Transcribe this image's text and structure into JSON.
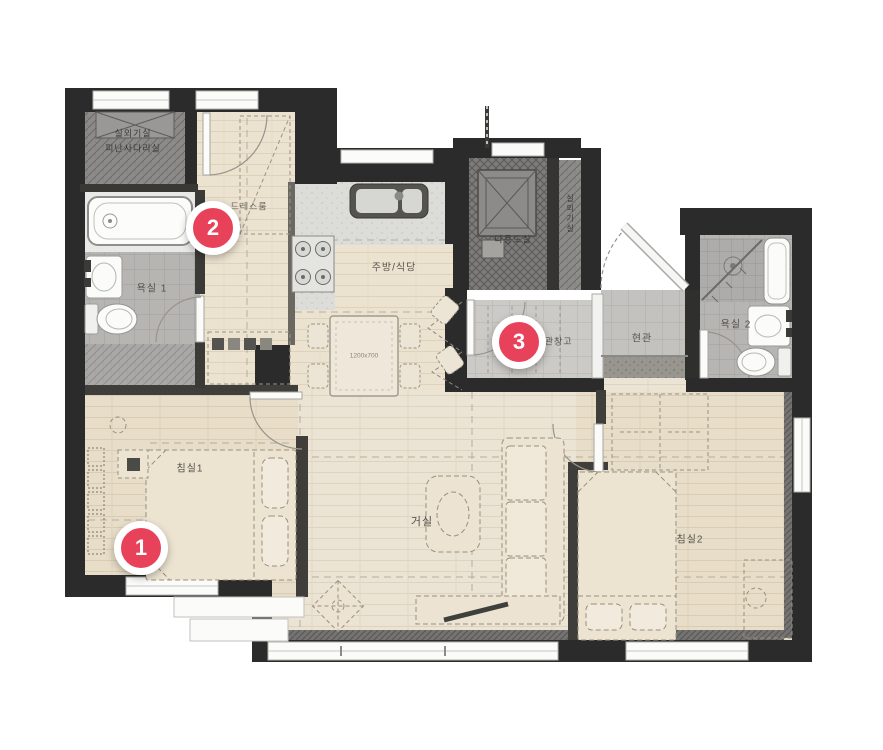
{
  "canvas": {
    "width": 883,
    "height": 750,
    "background": "#ffffff"
  },
  "colors": {
    "wall": "#2b2b2b",
    "marker_red": "#e8415a",
    "wood_floor": "#ebe3d3",
    "bedroom_floor": "#e7ddc8",
    "kitchen_floor": "#dcdcd8",
    "bath_tile": "#b7b5b2",
    "entry_tile": "#c3c2be",
    "dark_zone": "#7e7c7a"
  },
  "rooms": {
    "outdoor_unit": {
      "line1": "실외기실",
      "line2": "피난사다리실"
    },
    "dressroom": {
      "label": "드레스룸"
    },
    "bathroom1": {
      "label": "욕실 1"
    },
    "kitchen": {
      "label": "주방/식당"
    },
    "utility": {
      "label": "다용도실"
    },
    "ac_side": {
      "label": "실외기실"
    },
    "storage": {
      "label": "현관창고"
    },
    "entry": {
      "label": "현관"
    },
    "bathroom2": {
      "label": "욕실 2"
    },
    "bedroom1": {
      "label": "침실1"
    },
    "living": {
      "label": "거실"
    },
    "bedroom2": {
      "label": "침실2"
    }
  },
  "furniture": {
    "dining_table_label": "1200x700"
  },
  "markers": [
    {
      "number": "1"
    },
    {
      "number": "2"
    },
    {
      "number": "3"
    }
  ]
}
